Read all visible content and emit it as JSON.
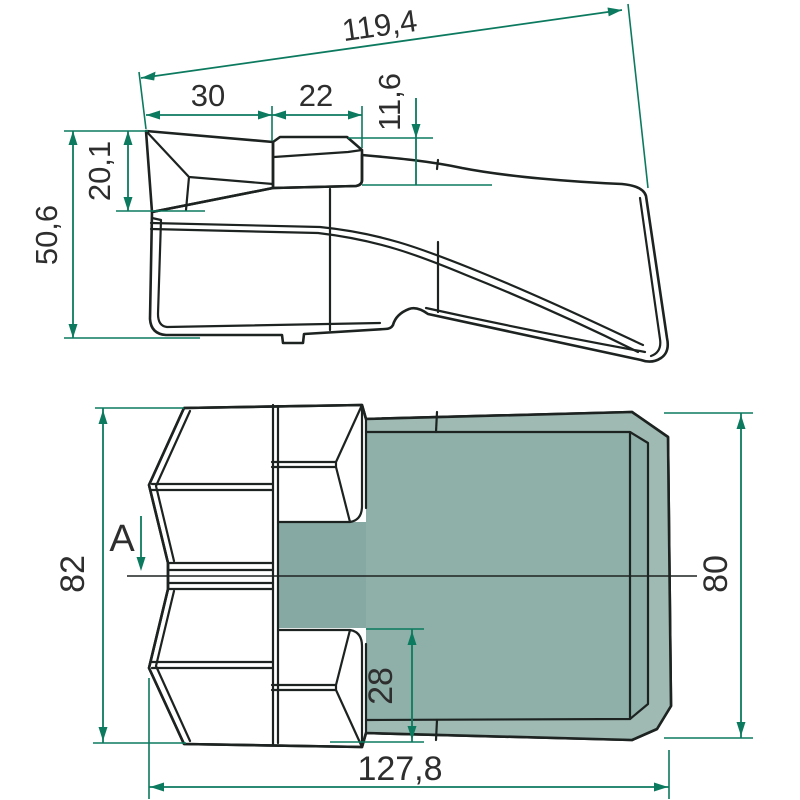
{
  "drawing": {
    "kind": "technical-drawing",
    "subject": "excavator-bucket-tooth",
    "views": {
      "side_view_name": "side-view",
      "plan_view_name": "plan-view"
    },
    "colors": {
      "face_light": "#cdd8d2",
      "face_medium": "#9fb9b3",
      "face_dark": "#8fafa9",
      "face_channel": "#87a9a4",
      "edge": "#1d2321",
      "dimension": "#0c7a5f",
      "text": "#2e2e2e",
      "background": "#ffffff"
    },
    "dimensions": {
      "side_view": {
        "overall_diagonal_length": "119,4",
        "tip_length": "30",
        "boss_length": "22",
        "boss_step_height": "11,6",
        "tip_height": "20,1",
        "overall_height": "50,6"
      },
      "plan_view": {
        "blade_width": "82",
        "body_width": "80",
        "wing_width": "28",
        "overall_length": "127,8",
        "section_label": "A"
      }
    }
  }
}
